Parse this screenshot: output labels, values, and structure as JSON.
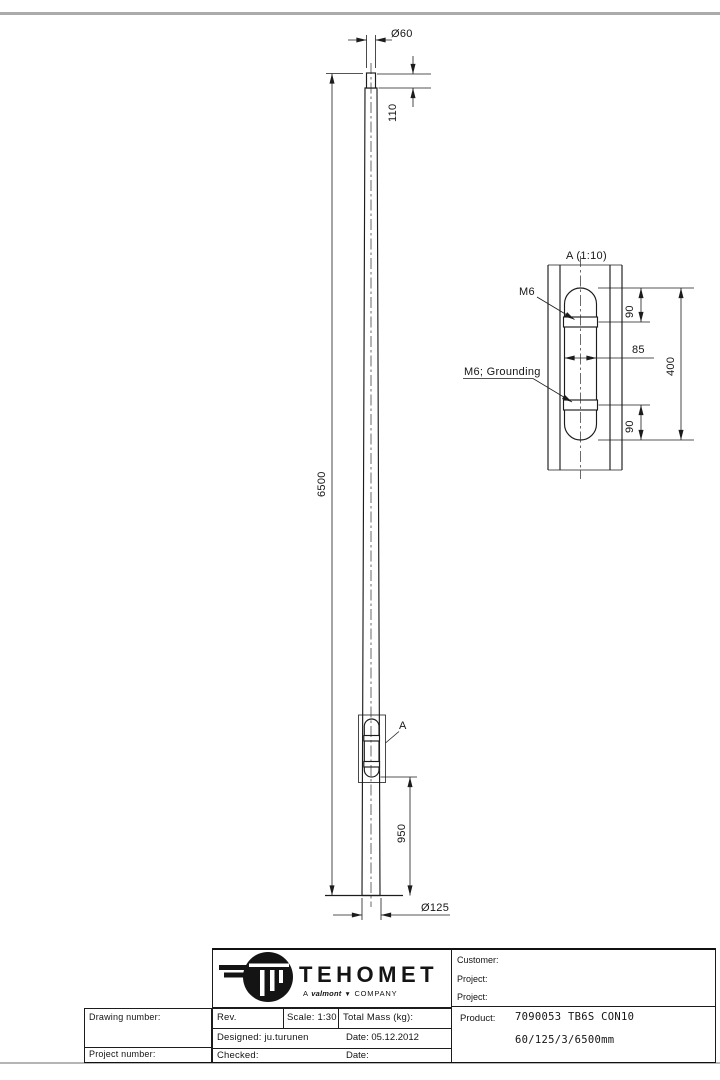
{
  "main_view": {
    "labels": {
      "top_diameter": "Ø60",
      "spigot_length": "110",
      "total_length": "6500",
      "door_to_base": "950",
      "base_diameter": "Ø125",
      "detail_marker": "A"
    }
  },
  "detail_view": {
    "title": "A (1:10)",
    "callouts": {
      "bolt": "M6",
      "grounding_bolt": "M6; Grounding"
    },
    "dims": {
      "bolt_top_offset": "90",
      "door_width": "85",
      "door_height": "400",
      "bolt_bottom_offset": "90"
    }
  },
  "title_block": {
    "logo": {
      "brand": "TEHOMET",
      "tagline_a": "A",
      "tagline_valmont": "valmont",
      "tagline_mark": "▼",
      "tagline_company": "COMPANY"
    },
    "left": {
      "drawing_number_label": "Drawing number:",
      "project_number_label": "Project number:"
    },
    "middle": {
      "rev_label": "Rev.",
      "scale": "Scale: 1:30",
      "total_mass_label": "Total Mass (kg):",
      "designed": "Designed: ju.turunen",
      "designed_date": "Date: 05.12.2012",
      "checked_label": "Checked:",
      "checked_date_label": "Date:"
    },
    "right": {
      "customer_label": "Customer:",
      "project_label_1": "Project:",
      "project_label_2": "Project:",
      "product_label": "Product:",
      "product_code": "7090053 TB6S CON10",
      "product_spec": "60/125/3/6500mm"
    }
  }
}
